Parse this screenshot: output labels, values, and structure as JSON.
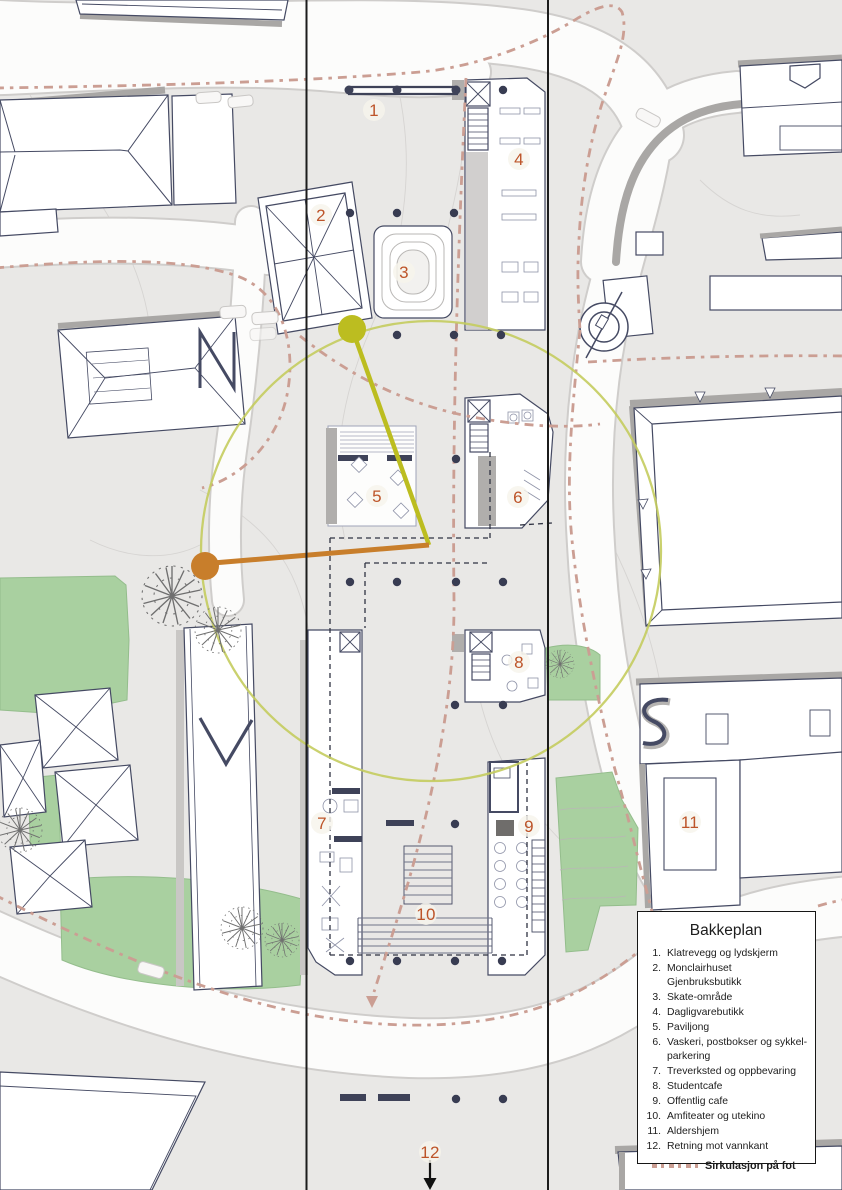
{
  "legend": {
    "title": "Bakkeplan",
    "items": [
      {
        "num": "1.",
        "label": "Klatrevegg og lydskjerm"
      },
      {
        "num": "2.",
        "label": "Monclairhuset Gjenbruksbutikk"
      },
      {
        "num": "3.",
        "label": "Skate-område"
      },
      {
        "num": "4.",
        "label": "Dagligvarebutikk"
      },
      {
        "num": "5.",
        "label": "Paviljong"
      },
      {
        "num": "6.",
        "label": "Vaskeri, postbokser og sykkel-parkering"
      },
      {
        "num": "7.",
        "label": "Treverksted og oppbevaring"
      },
      {
        "num": "8.",
        "label": "Studentcafe"
      },
      {
        "num": "9.",
        "label": "Offentlig cafe"
      },
      {
        "num": "10.",
        "label": "Amfiteater og utekino"
      },
      {
        "num": "11.",
        "label": "Aldershjem"
      },
      {
        "num": "12.",
        "label": "Retning mot vannkant"
      }
    ],
    "footer_label": "Sirkulasjon på fot"
  },
  "plan_labels": [
    {
      "num": "1",
      "x": 374,
      "y": 110
    },
    {
      "num": "2",
      "x": 321,
      "y": 215
    },
    {
      "num": "3",
      "x": 404,
      "y": 272
    },
    {
      "num": "4",
      "x": 519,
      "y": 159
    },
    {
      "num": "5",
      "x": 377,
      "y": 496
    },
    {
      "num": "6",
      "x": 518,
      "y": 497
    },
    {
      "num": "7",
      "x": 322,
      "y": 823
    },
    {
      "num": "8",
      "x": 519,
      "y": 662
    },
    {
      "num": "9",
      "x": 529,
      "y": 826
    },
    {
      "num": "10",
      "x": 426,
      "y": 914
    },
    {
      "num": "11",
      "x": 690,
      "y": 822
    },
    {
      "num": "12",
      "x": 430,
      "y": 1152
    }
  ],
  "colors": {
    "label": "#bd5429",
    "circulation": "#cb9e93",
    "radius_circle": "#c4cc5e",
    "marker_yellow": "#bcbd20",
    "marker_orange": "#c87e2b",
    "green": "#a9d0a0",
    "building_outline": "#454a63"
  }
}
